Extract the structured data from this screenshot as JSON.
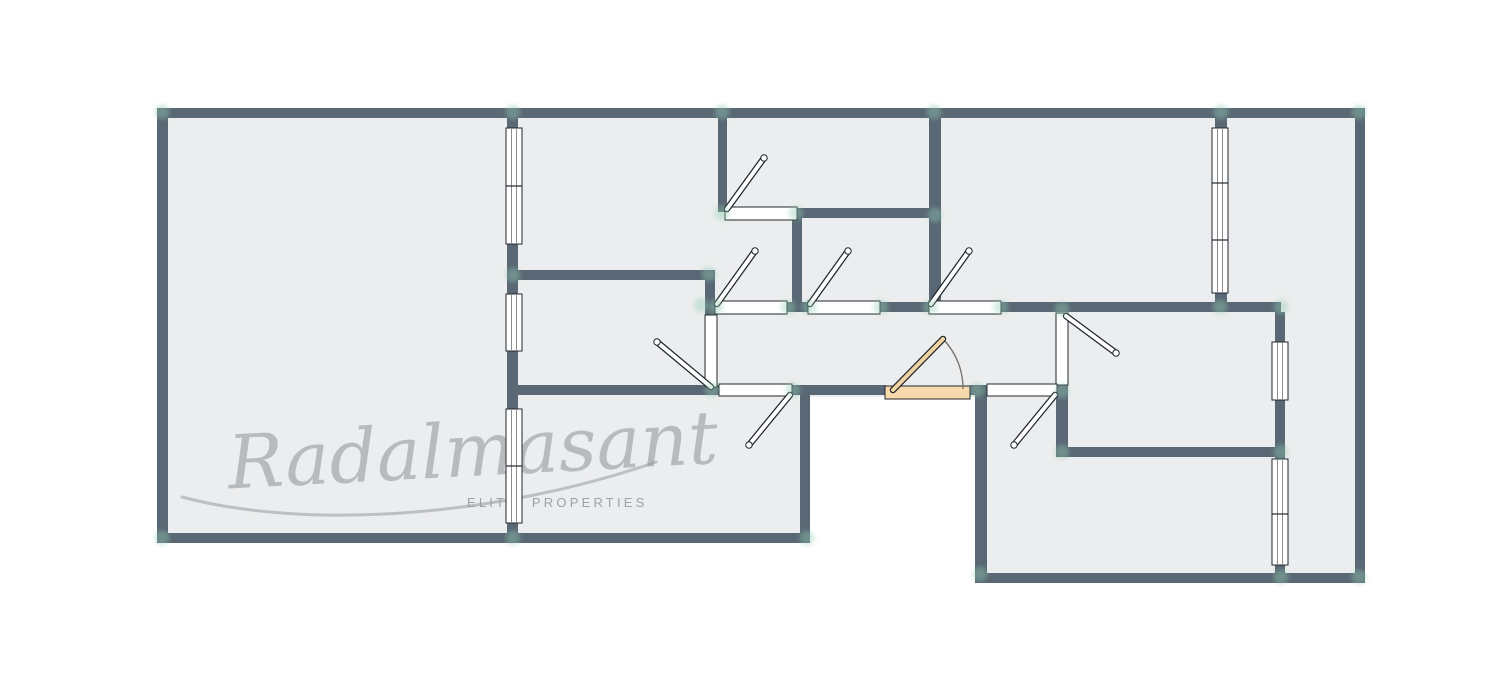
{
  "watermark": {
    "script": "Radalmasant",
    "subtitle": "ELITE PROPERTIES"
  },
  "colors": {
    "background": "#ffffff",
    "wall": "#596874",
    "floor": "#ecedee",
    "outline": "#20262b",
    "window_fill": "#ffffff",
    "glazing_line": "#707070",
    "door_fill": "#ffffff",
    "entrance_fill": "#f7d9ab",
    "entrance_leaf": "#efd3a3",
    "arc": "#6f6f6f",
    "snap": "#93cdb4",
    "watermark": "#8e9397",
    "watermark_sub": "#969b9f"
  },
  "plan": {
    "floors": [
      [
        165,
        112,
        645,
        428
      ],
      [
        810,
        112,
        165,
        285
      ],
      [
        975,
        112,
        385,
        466
      ]
    ],
    "walls": [
      [
        157,
        108,
        1208,
        10
      ],
      [
        157,
        108,
        11,
        435
      ],
      [
        157,
        533,
        653,
        10
      ],
      [
        1355,
        108,
        10,
        475
      ],
      [
        975,
        573,
        390,
        10
      ],
      [
        507,
        108,
        11,
        20
      ],
      [
        507,
        244,
        11,
        50
      ],
      [
        507,
        351,
        11,
        58
      ],
      [
        507,
        523,
        11,
        20
      ],
      [
        718,
        108,
        9,
        104
      ],
      [
        797,
        208,
        135,
        10
      ],
      [
        792,
        218,
        10,
        88
      ],
      [
        507,
        270,
        208,
        10
      ],
      [
        705,
        270,
        10,
        45
      ],
      [
        787,
        302,
        21,
        10
      ],
      [
        880,
        302,
        49,
        10
      ],
      [
        1000,
        302,
        281,
        10
      ],
      [
        929,
        108,
        12,
        196
      ],
      [
        1215,
        118,
        12,
        12
      ],
      [
        1215,
        291,
        12,
        13
      ],
      [
        1056,
        385,
        12,
        62
      ],
      [
        1056,
        447,
        229,
        10
      ],
      [
        1275,
        312,
        10,
        30
      ],
      [
        1275,
        400,
        10,
        59
      ],
      [
        1275,
        565,
        10,
        18
      ],
      [
        507,
        385,
        212,
        10
      ],
      [
        792,
        385,
        94,
        10
      ],
      [
        970,
        385,
        18,
        10
      ],
      [
        800,
        395,
        10,
        148
      ],
      [
        975,
        395,
        12,
        183
      ]
    ],
    "windows": [
      {
        "x": 506,
        "y": 128,
        "w": 16,
        "h": 116,
        "dividers": [
          186
        ]
      },
      {
        "x": 506,
        "y": 294,
        "w": 16,
        "h": 57,
        "dividers": []
      },
      {
        "x": 506,
        "y": 409,
        "w": 16,
        "h": 114,
        "dividers": [
          466
        ]
      },
      {
        "x": 1212,
        "y": 128,
        "w": 16,
        "h": 165,
        "dividers": [
          183,
          240
        ]
      },
      {
        "x": 1272,
        "y": 342,
        "w": 16,
        "h": 58,
        "dividers": []
      },
      {
        "x": 1272,
        "y": 459,
        "w": 16,
        "h": 106,
        "dividers": [
          514
        ]
      }
    ],
    "door_openings": [
      {
        "rect": [
          725,
          207,
          72,
          13
        ],
        "style": "interior"
      },
      {
        "rect": [
          715,
          301,
          72,
          13
        ],
        "style": "interior"
      },
      {
        "rect": [
          808,
          301,
          72,
          13
        ],
        "style": "interior"
      },
      {
        "rect": [
          929,
          301,
          72,
          13
        ],
        "style": "interior"
      },
      {
        "rect": [
          705,
          315,
          12,
          72
        ],
        "style": "interior"
      },
      {
        "rect": [
          1056,
          313,
          12,
          72
        ],
        "style": "interior"
      },
      {
        "rect": [
          719,
          384,
          73,
          12
        ],
        "style": "interior"
      },
      {
        "rect": [
          987,
          384,
          70,
          12
        ],
        "style": "interior"
      },
      {
        "rect": [
          885,
          386,
          85,
          13
        ],
        "style": "entrance"
      }
    ],
    "door_leaves": [
      {
        "from": [
          727,
          209
        ],
        "to": [
          764,
          158
        ],
        "style": "interior"
      },
      {
        "from": [
          717,
          304
        ],
        "to": [
          755,
          251
        ],
        "style": "interior"
      },
      {
        "from": [
          810,
          304
        ],
        "to": [
          848,
          251
        ],
        "style": "interior"
      },
      {
        "from": [
          931,
          304
        ],
        "to": [
          969,
          251
        ],
        "style": "interior"
      },
      {
        "from": [
          711,
          387
        ],
        "to": [
          657,
          342
        ],
        "style": "interior"
      },
      {
        "from": [
          1066,
          316
        ],
        "to": [
          1116,
          353
        ],
        "style": "interior"
      },
      {
        "from": [
          790,
          395
        ],
        "to": [
          749,
          445
        ],
        "style": "interior"
      },
      {
        "from": [
          1055,
          395
        ],
        "to": [
          1014,
          445
        ],
        "style": "interior"
      },
      {
        "from": [
          893,
          390
        ],
        "to": [
          943,
          339
        ],
        "style": "entrance"
      }
    ],
    "entrance_arc": {
      "d": "M 943 339 A 71 71 0 0 1 963 389"
    },
    "snap_points": [
      [
        162,
        112
      ],
      [
        513,
        112
      ],
      [
        722,
        112
      ],
      [
        934,
        112
      ],
      [
        1221,
        112
      ],
      [
        1359,
        112
      ],
      [
        722,
        213
      ],
      [
        796,
        213
      ],
      [
        935,
        215
      ],
      [
        513,
        275
      ],
      [
        709,
        274
      ],
      [
        701,
        305
      ],
      [
        716,
        307
      ],
      [
        788,
        307
      ],
      [
        809,
        307
      ],
      [
        881,
        307
      ],
      [
        930,
        307
      ],
      [
        1001,
        307
      ],
      [
        1220,
        307
      ],
      [
        1281,
        307
      ],
      [
        1062,
        309
      ],
      [
        712,
        390
      ],
      [
        793,
        390
      ],
      [
        977,
        390
      ],
      [
        1062,
        391
      ],
      [
        1062,
        452
      ],
      [
        1281,
        452
      ],
      [
        162,
        538
      ],
      [
        513,
        538
      ],
      [
        807,
        538
      ],
      [
        980,
        574
      ],
      [
        1281,
        577
      ],
      [
        1359,
        577
      ]
    ]
  }
}
